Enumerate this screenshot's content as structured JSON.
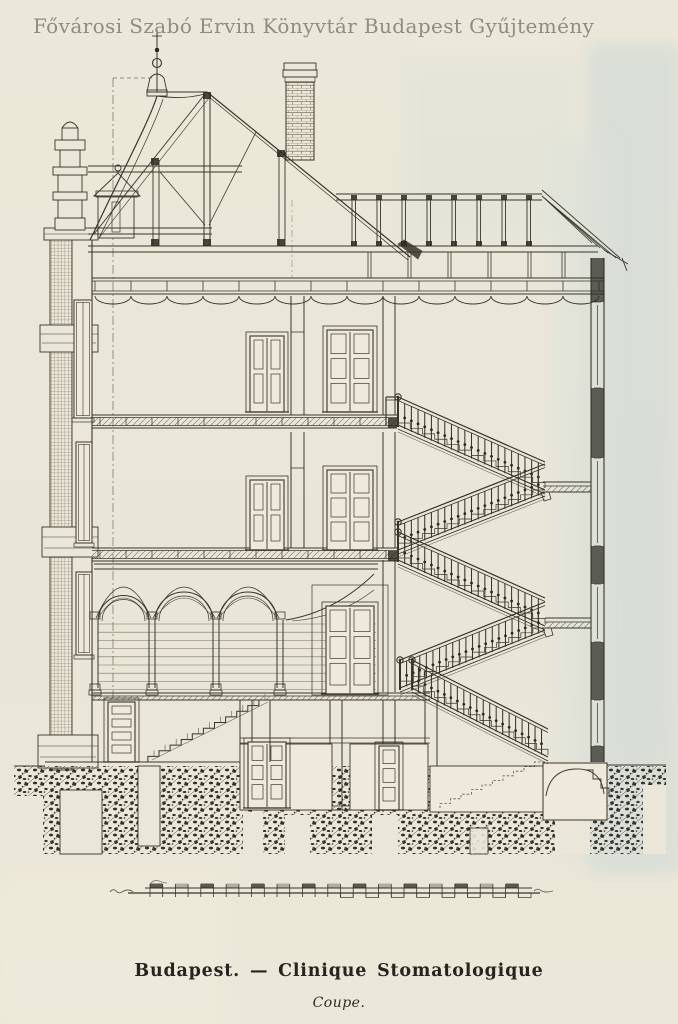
{
  "palette": {
    "paper": "#ebe7d8",
    "wash_blue": "#d7ded8",
    "ink": "#39352b",
    "ink_dark": "#2b2822",
    "watermark_color": "#8b897c",
    "caption_color": "#262420"
  },
  "watermark": {
    "text": "Fővárosi Szabó Ervin Könyvtár Budapest Gyűjtemény"
  },
  "caption": {
    "title": "Budapest. — Clinique Stomatologique",
    "subtitle": "Coupe."
  }
}
